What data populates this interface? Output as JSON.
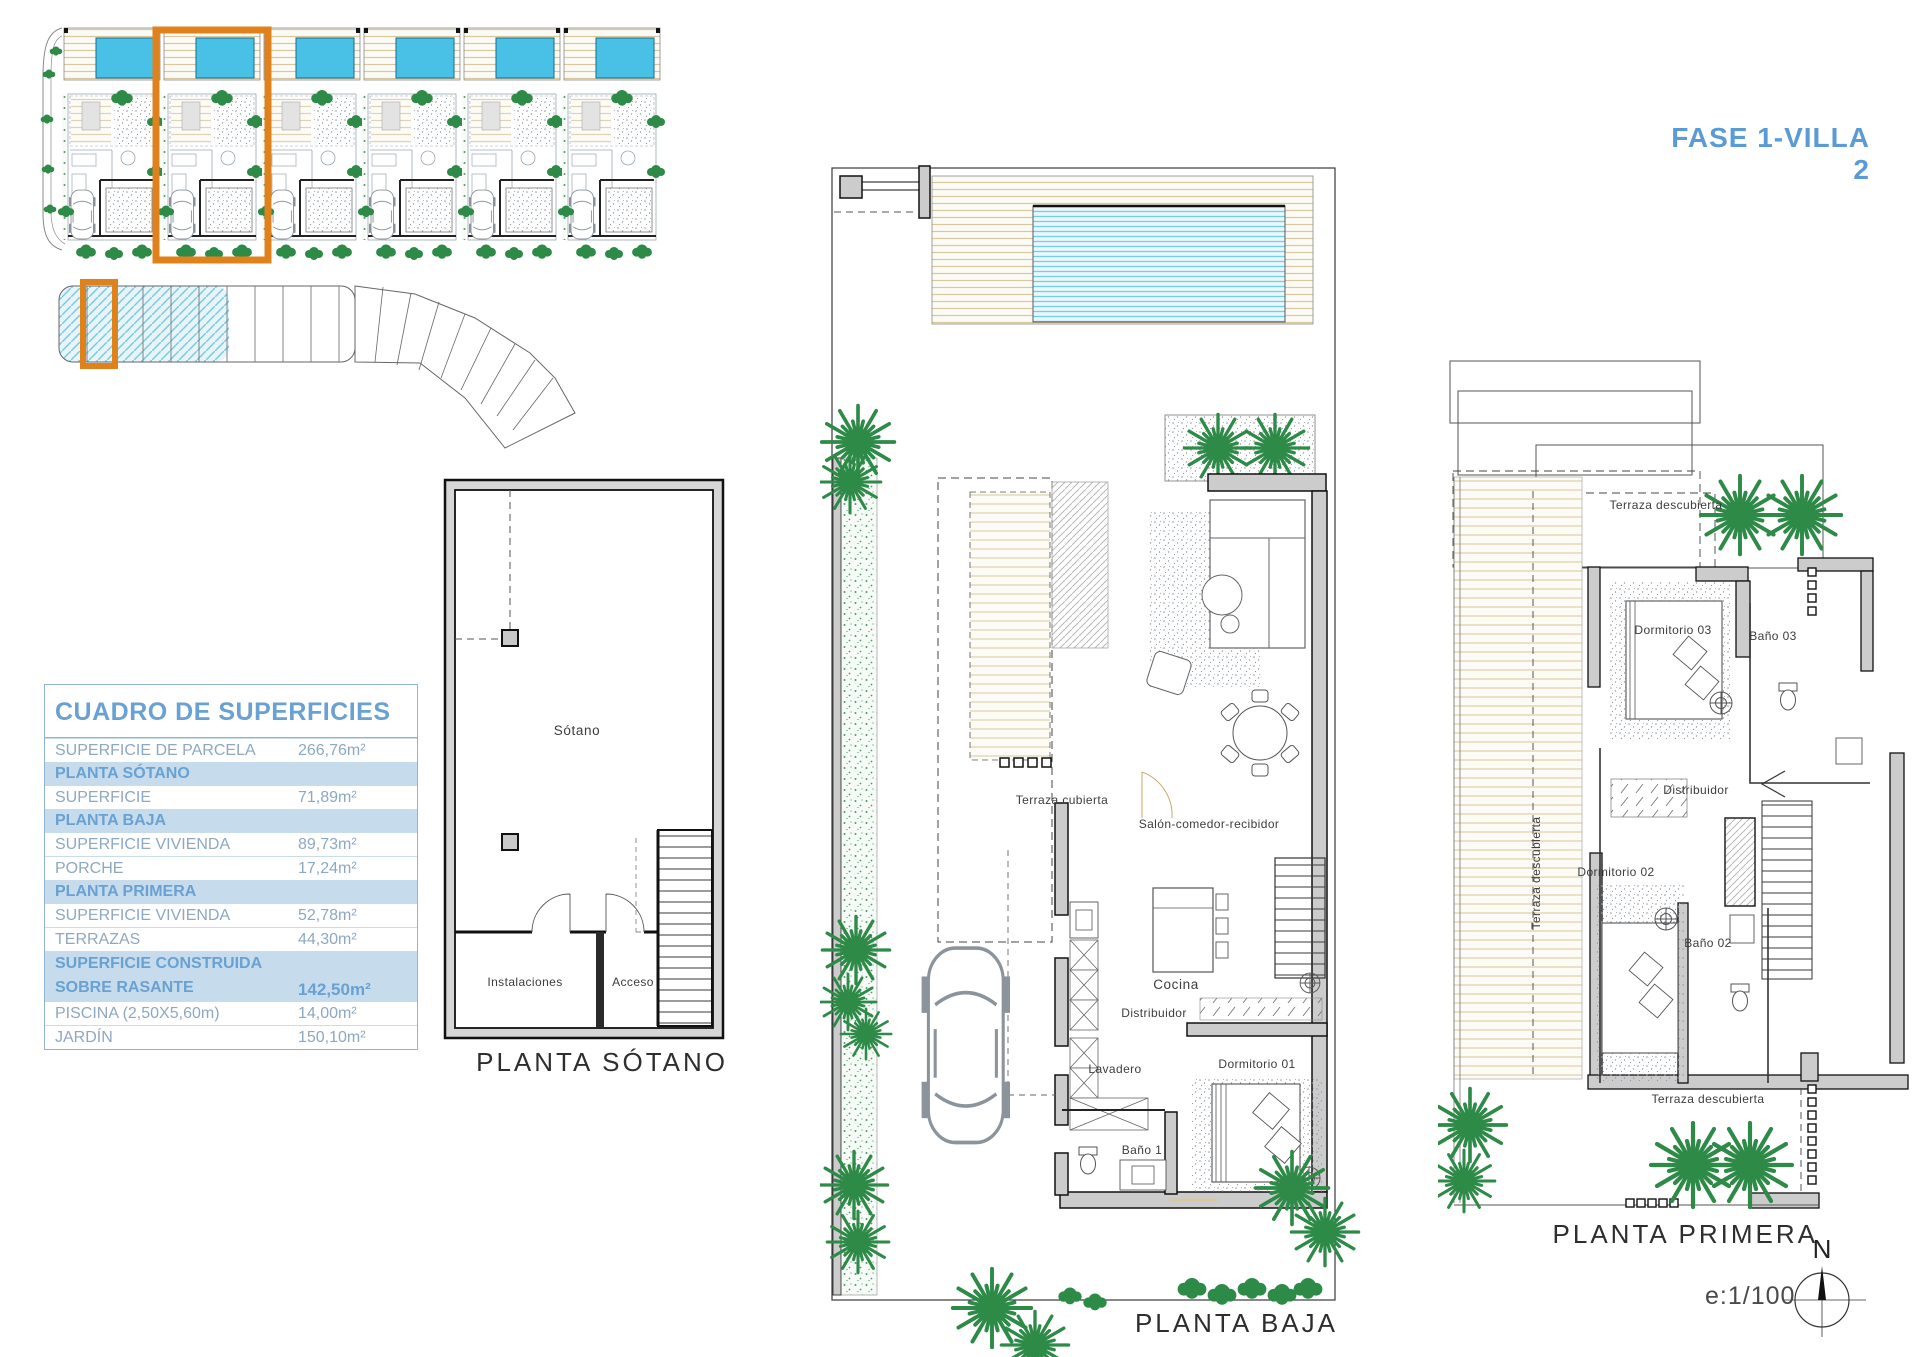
{
  "title": "FASE 1-VILLA 2",
  "table": {
    "title": "CUADRO DE SUPERFICIES",
    "rows": [
      {
        "label": "SUPERFICIE DE PARCELA",
        "value": "266,76m²",
        "type": "data"
      },
      {
        "label": "PLANTA SÓTANO",
        "type": "section"
      },
      {
        "label": "SUPERFICIE",
        "value": "71,89m²",
        "type": "data"
      },
      {
        "label": "PLANTA BAJA",
        "type": "section"
      },
      {
        "label": "SUPERFICIE VIVIENDA",
        "value": "89,73m²",
        "type": "data"
      },
      {
        "label": "PORCHE",
        "value": "17,24m²",
        "type": "data"
      },
      {
        "label": "PLANTA PRIMERA",
        "type": "section"
      },
      {
        "label": "SUPERFICIE VIVIENDA",
        "value": "52,78m²",
        "type": "data"
      },
      {
        "label": "TERRAZAS",
        "value": "44,30m²",
        "type": "data"
      },
      {
        "label": "SUPERFICIE CONSTRUIDA",
        "label2": "SOBRE RASANTE",
        "value": "142,50m²",
        "type": "total"
      },
      {
        "label": "PISCINA (2,50X5,60m)",
        "value": "14,00m²",
        "type": "data"
      },
      {
        "label": "JARDÍN",
        "value": "150,10m²",
        "type": "data"
      }
    ]
  },
  "plans": {
    "sotano": {
      "title": "PLANTA SÓTANO",
      "rooms": {
        "main": "Sótano",
        "instalaciones": "Instalaciones",
        "acceso": "Acceso"
      }
    },
    "baja": {
      "title": "PLANTA BAJA",
      "rooms": {
        "terraza_cubierta": "Terraza cubierta",
        "salon": "Salón-comedor-recibidor",
        "cocina": "Cocina",
        "distribuidor": "Distribuidor",
        "lavadero": "Lavadero",
        "dormitorio_01": "Dormitorio 01",
        "bano_1": "Baño 1"
      }
    },
    "primera": {
      "title": "PLANTA PRIMERA",
      "rooms": {
        "terraza_descubierta_top": "Terraza descubierta",
        "terraza_descubierta_left": "Terraza descubierta",
        "terraza_descubierta_bottom": "Terraza descubierta",
        "dormitorio_03": "Dormitorio 03",
        "bano_03": "Baño 03",
        "distribuidor": "Distribuidor",
        "dormitorio_02": "Dormitorio 02",
        "bano_02": "Baño 02"
      }
    }
  },
  "compass": {
    "north_label": "N",
    "scale_label": "e:1/100"
  },
  "colors": {
    "accent_blue": "#5B9BD5",
    "highlight_orange": "#E0821C",
    "pool_cyan": "#49C1E6",
    "table_section_bg": "#c6dcec"
  }
}
